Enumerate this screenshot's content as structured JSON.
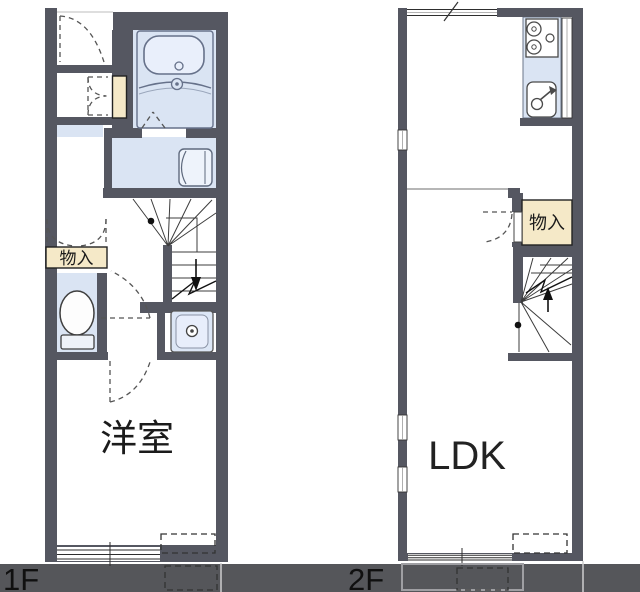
{
  "title": "2-story apartment floor plan",
  "labels": {
    "floor1_room": "洋室",
    "floor1_storage": "物入",
    "floor2_room": "LDK",
    "floor2_storage": "物入",
    "floor1_tag": "1F",
    "floor2_tag": "2F"
  },
  "floors": [
    {
      "tag": "1F",
      "rooms": [
        "洋室",
        "物入"
      ],
      "fixtures": [
        "bathtub",
        "washing-machine",
        "toilet",
        "washbasin",
        "shoe-cabinet",
        "staircase-down",
        "entrance-door"
      ]
    },
    {
      "tag": "2F",
      "rooms": [
        "LDK",
        "物入"
      ],
      "fixtures": [
        "stove",
        "kitchen-sink",
        "staircase-up",
        "balcony"
      ]
    }
  ],
  "colors": {
    "wall": "#555761",
    "water_area": "#dae4f3",
    "storage_fill": "#f5e9c8",
    "fixture_fill": "#eef3fb",
    "ground_band": "#55565a",
    "dashed_line": "#555555",
    "text": "#1b1b1b"
  }
}
